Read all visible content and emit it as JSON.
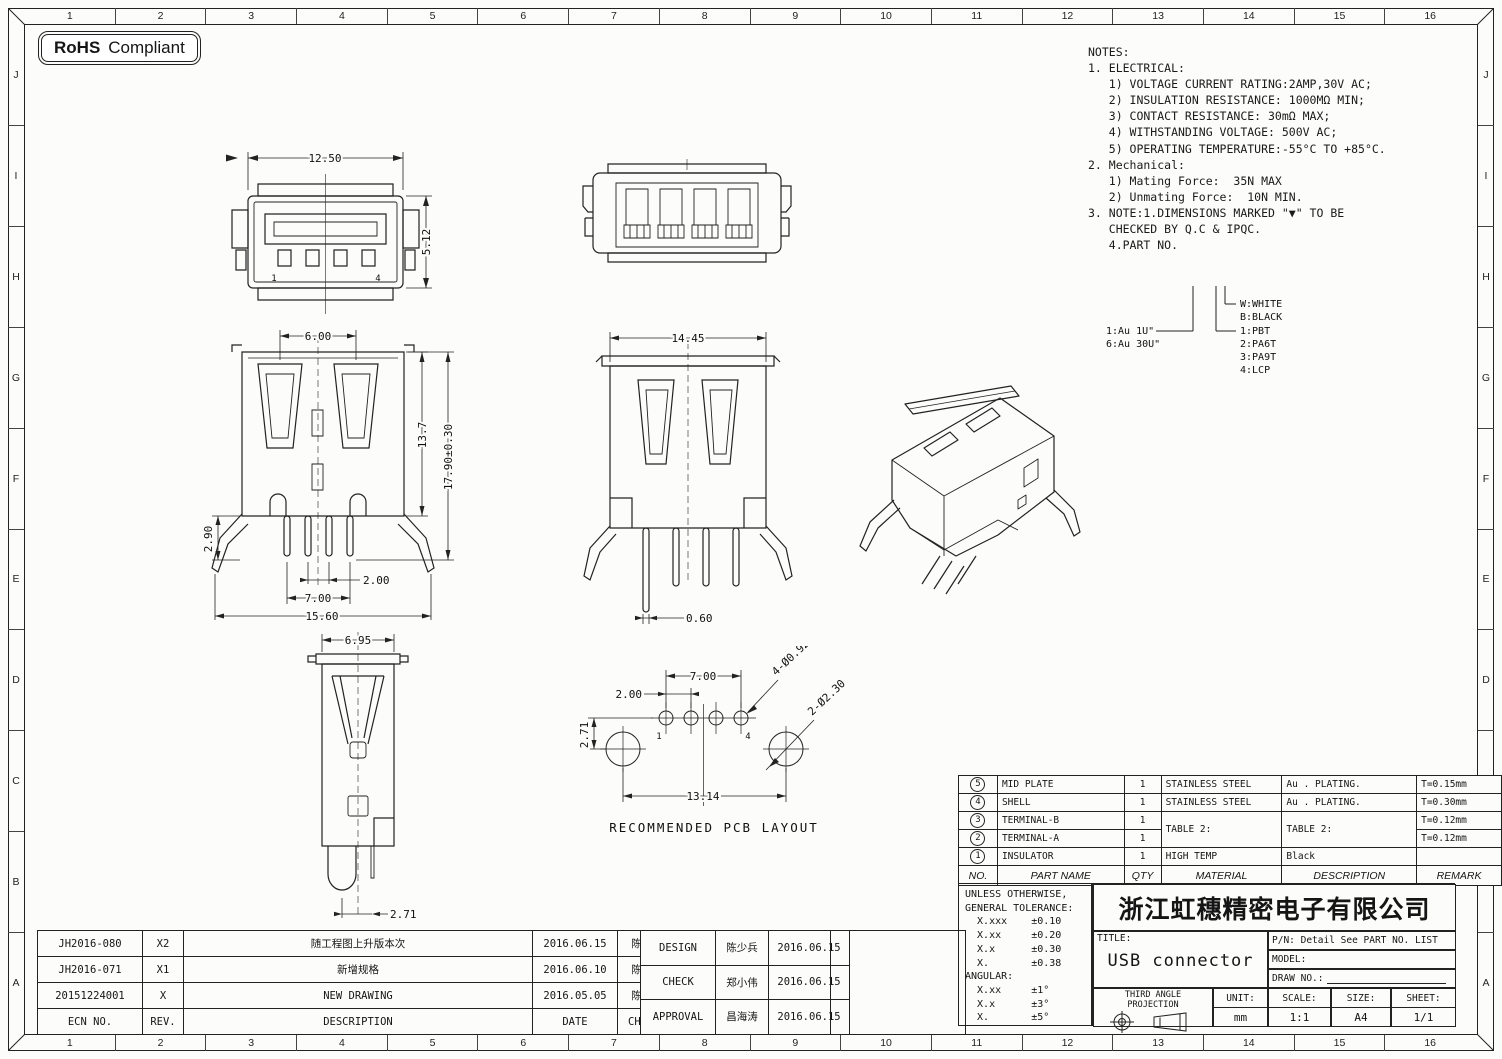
{
  "badge": {
    "bold": "RoHS",
    "rest": "Compliant"
  },
  "ruler": {
    "cols": [
      "1",
      "2",
      "3",
      "4",
      "5",
      "6",
      "7",
      "8",
      "9",
      "10",
      "11",
      "12",
      "13",
      "14",
      "15",
      "16"
    ],
    "rows": [
      "J",
      "I",
      "H",
      "G",
      "F",
      "E",
      "D",
      "C",
      "B",
      "A"
    ]
  },
  "notes": {
    "lines": [
      "NOTES:",
      "1. ELECTRICAL:",
      "   1) VOLTAGE CURRENT RATING:2AMP,30V AC;",
      "   2) INSULATION RESISTANCE: 1000MΩ MIN;",
      "   3) CONTACT RESISTANCE: 30mΩ MAX;",
      "   4) WITHSTANDING VOLTAGE: 500V AC;",
      "   5) OPERATING TEMPERATURE:-55°C TO +85°C.",
      "2. Mechanical:",
      "   1) Mating Force:  35N MAX",
      "   2) Unmating Force:  10N MIN.",
      "3. NOTE:1.DIMENSIONS MARKED \"▼\" TO BE",
      "   CHECKED BY Q.C & IPQC.",
      "",
      "   4.PART NO."
    ]
  },
  "legend": {
    "au1": "1:Au 1U\"",
    "au2": "6:Au 30U\"",
    "w": "W:WHITE",
    "b": "B:BLACK",
    "m1": "1:PBT",
    "m2": "2:PA6T",
    "m3": "3:PA9T",
    "m4": "4:LCP"
  },
  "views": {
    "front": {
      "dim_w": "12.50",
      "dim_h": "5.12",
      "pin1": "1",
      "pin4": "4"
    },
    "side": {
      "d600": "6.00",
      "d290": "2.90",
      "d137": "13.7",
      "d1790": "17.90±0.30",
      "d200": "2.00",
      "d700": "7.00",
      "d1560": "15.60"
    },
    "front2": {
      "d1445": "14.45",
      "d060": "0.60"
    },
    "profile": {
      "d695": "6.95",
      "d271": "2.71"
    },
    "pcb": {
      "d700": "7.00",
      "d200": "2.00",
      "d271": "2.71",
      "d1314": "13.14",
      "holes4": "4-Ø0.92",
      "holes2": "2-Ø2.30",
      "pin1": "1",
      "pin4": "4",
      "caption": "RECOMMENDED PCB LAYOUT"
    }
  },
  "parts_table": {
    "headers": [
      "NO.",
      "PART NAME",
      "QTY",
      "MATERIAL",
      "DESCRIPTION",
      "REMARK"
    ],
    "rows": [
      {
        "no": "5",
        "name": "MID PLATE",
        "qty": "1",
        "material": "STAINLESS STEEL",
        "description": "Au . PLATING.",
        "remark": "T=0.15mm"
      },
      {
        "no": "4",
        "name": "SHELL",
        "qty": "1",
        "material": "STAINLESS STEEL",
        "description": "Au . PLATING.",
        "remark": "T=0.30mm"
      },
      {
        "no": "3",
        "name": "TERMINAL-B",
        "qty": "1",
        "material": "TABLE 2:",
        "description": "TABLE 2:",
        "remark": "T=0.12mm"
      },
      {
        "no": "2",
        "name": "TERMINAL-A",
        "qty": "1",
        "material": "",
        "description": "",
        "remark": "T=0.12mm"
      },
      {
        "no": "1",
        "name": "INSULATOR",
        "qty": "1",
        "material": "HIGH TEMP",
        "description": "Black",
        "remark": ""
      }
    ]
  },
  "tolerance": {
    "lines": [
      "UNLESS OTHERWISE,",
      "GENERAL TOLERANCE:",
      "  X.xxx    ±0.10",
      "  X.xx     ±0.20",
      "  X.x      ±0.30",
      "  X.       ±0.38",
      "ANGULAR:",
      "  X.xx     ±1°",
      "  X.x      ±3°",
      "  X.       ±5°"
    ]
  },
  "title_block": {
    "company": "浙江虹穗精密电子有限公司",
    "title_label": "TITLE:",
    "title": "USB connector",
    "pn": "P/N: Detail See PART NO. LIST",
    "model_label": "MODEL:",
    "draw_no_label": "DRAW NO.:",
    "projection": "THIRD ANGLE PROJECTION",
    "unit_label": "UNIT:",
    "unit": "mm",
    "scale_label": "SCALE:",
    "scale": "1:1",
    "size_label": "SIZE:",
    "size": "A4",
    "sheet_label": "SHEET:",
    "sheet": "1/1"
  },
  "revisions": {
    "headers": [
      "ECN NO.",
      "REV.",
      "DESCRIPTION",
      "DATE",
      "CHANGE"
    ],
    "rows": [
      [
        "JH2016-080",
        "X2",
        "随工程图上升版本次",
        "2016.06.15",
        "陈少兵"
      ],
      [
        "JH2016-071",
        "X1",
        "新增规格",
        "2016.06.10",
        "陈少兵"
      ],
      [
        "20151224001",
        "X",
        "NEW DRAWING",
        "2016.05.05",
        "陈少兵"
      ]
    ]
  },
  "approvals": {
    "rows": [
      [
        "DESIGN",
        "陈少兵",
        "2016.06.15"
      ],
      [
        "CHECK",
        "郑小伟",
        "2016.06.15"
      ],
      [
        "APPROVAL",
        "昌海涛",
        "2016.06.15"
      ]
    ]
  }
}
